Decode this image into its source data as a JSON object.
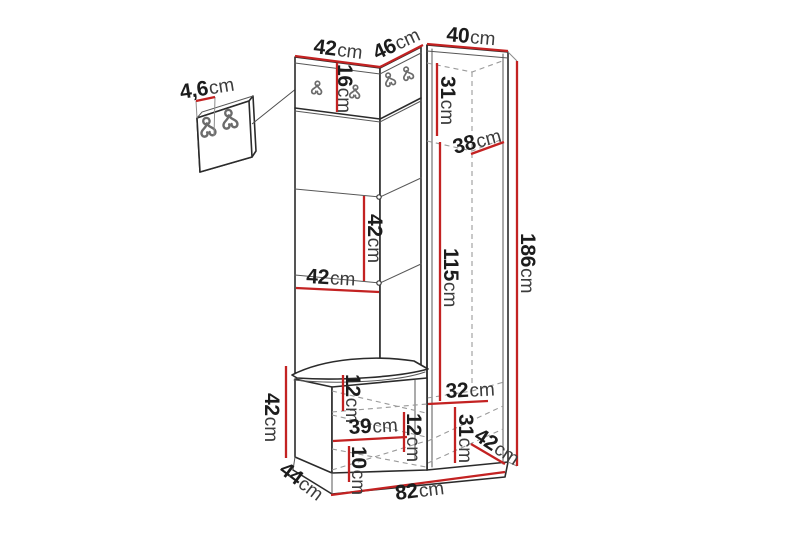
{
  "meta": {
    "description": "Dimension diagram of a hallway furniture set (corner wardrobe with hook panel, open shelves, tall cabinet and seat bench) with measurements in centimetres",
    "unit": "cm"
  },
  "colors": {
    "dimension": "#c32222",
    "outline": "#2b2b2b",
    "hidden": "#9a9a9a",
    "text": "#1c1c1c"
  },
  "labels": {
    "hook_spacing": {
      "num": "4,6",
      "unit": "cm"
    },
    "top_width_left": {
      "num": "42",
      "unit": "cm"
    },
    "top_width_corner": {
      "num": "46",
      "unit": "cm"
    },
    "top_width_right": {
      "num": "40",
      "unit": "cm"
    },
    "hook_panel_height": {
      "num": "16",
      "unit": "cm"
    },
    "cabinet_top_height": {
      "num": "31",
      "unit": "cm"
    },
    "cabinet_shelf_depth": {
      "num": "38",
      "unit": "cm"
    },
    "shelf_spacing": {
      "num": "42",
      "unit": "cm"
    },
    "column_width": {
      "num": "42",
      "unit": "cm"
    },
    "cabinet_inner_height": {
      "num": "115",
      "unit": "cm"
    },
    "total_height": {
      "num": "186",
      "unit": "cm"
    },
    "bench_height": {
      "num": "42",
      "unit": "cm"
    },
    "bench_top_inset": {
      "num": "12",
      "unit": "cm"
    },
    "bench_inner_width": {
      "num": "39",
      "unit": "cm"
    },
    "bench_inner_height": {
      "num": "12",
      "unit": "cm"
    },
    "bench_plinth_height": {
      "num": "10",
      "unit": "cm"
    },
    "cabinet_bottom_width": {
      "num": "32",
      "unit": "cm"
    },
    "cabinet_bottom_height": {
      "num": "31",
      "unit": "cm"
    },
    "cabinet_depth": {
      "num": "42",
      "unit": "cm"
    },
    "bench_depth": {
      "num": "44",
      "unit": "cm"
    },
    "total_width": {
      "num": "82",
      "unit": "cm"
    }
  }
}
